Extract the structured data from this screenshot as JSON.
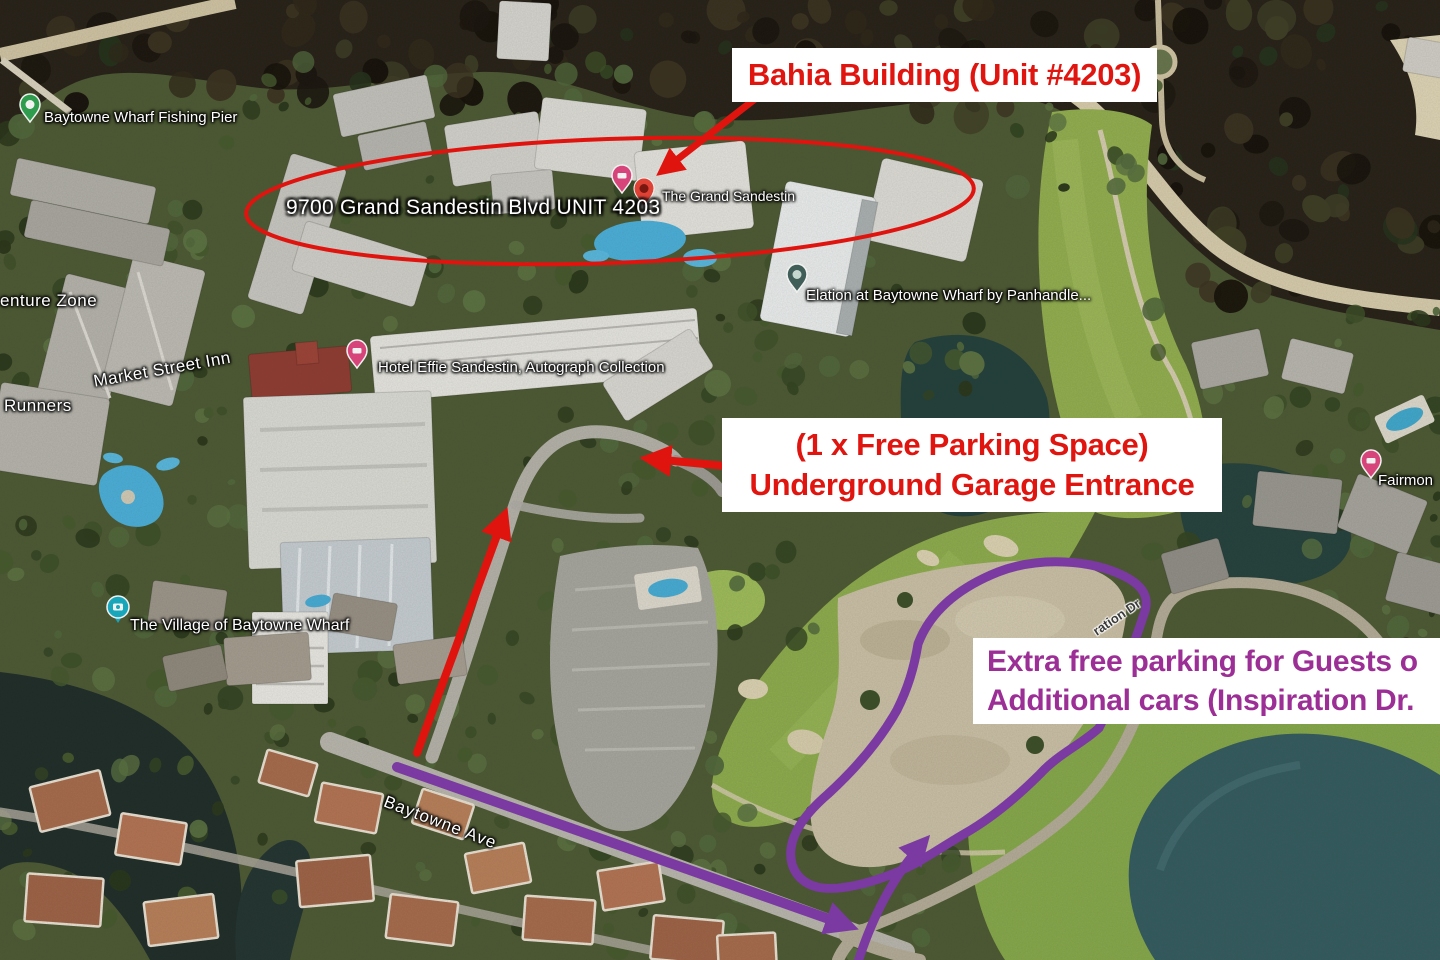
{
  "callouts": {
    "bahia_building": "Bahia Building (Unit #4203)",
    "parking_line1": "(1 x Free Parking Space)",
    "parking_line2": "Underground Garage Entrance",
    "extra_line1": "Extra free parking for Guests o",
    "extra_line2": "Additional cars (Inspiration Dr.",
    "address_circle": "9700 Grand Sandestin Blvd UNIT 4203"
  },
  "map_labels": {
    "fishing_pier": "Baytowne Wharf Fishing Pier",
    "adventure_zone": "enture Zone",
    "market_street_inn": "Market Street Inn",
    "runners": "Runners",
    "hotel_effie": "Hotel Effie Sandestin, Autograph Collection",
    "grand_sandestin": "The Grand Sandestin",
    "elation": "Elation at Baytowne Wharf by Panhandle...",
    "village": "The Village of Baytowne Wharf",
    "fairmont": "Fairmon",
    "baytowne_ave": "Baytowne Ave",
    "inspiration_dr": "ration Dr"
  },
  "pins": {
    "fishing_pier": "green-place-pin",
    "hotel_effie": "pink-lodging-pin",
    "grand_sandestin_lodging": "pink-lodging-pin",
    "grand_sandestin_place": "red-place-pin",
    "elation": "dark-place-pin",
    "village": "teal-camera-pin",
    "fairmont": "pink-lodging-pin"
  },
  "colors": {
    "red_annotation": "#e0150f",
    "purple_annotation_text": "#9c2f96",
    "purple_route": "#7a3aa1",
    "callout_background": "#ffffff",
    "map_label_text": "#ffffff"
  }
}
